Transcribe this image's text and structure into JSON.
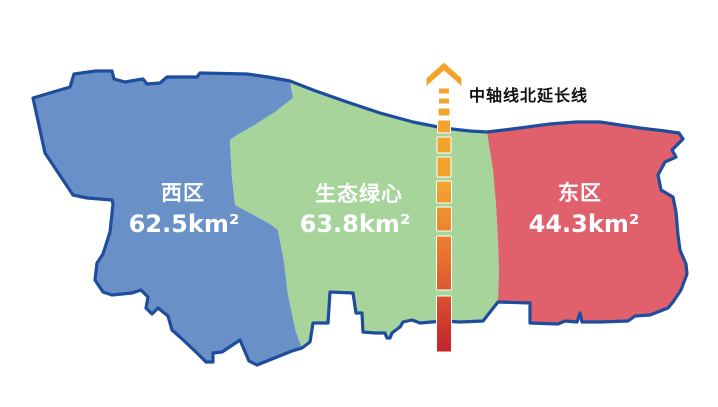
{
  "map": {
    "background": "#ffffff",
    "outline_color": "#1d4d9c",
    "label_text_color": "#ffffff",
    "regions": [
      {
        "id": "west",
        "name": "西区",
        "area": "62.5km²",
        "fill": "#6a90c8"
      },
      {
        "id": "green-heart",
        "name": "生态绿心",
        "area": "63.8km²",
        "fill": "#a6d49b"
      },
      {
        "id": "east",
        "name": "东区",
        "area": "44.3km²",
        "fill": "#e0606b"
      }
    ],
    "axis": {
      "label": "中轴线北延长线",
      "label_color": "#111111",
      "color_top": "#f2a42f",
      "color_mid": "#e8702d",
      "color_bottom": "#c2232f"
    }
  }
}
